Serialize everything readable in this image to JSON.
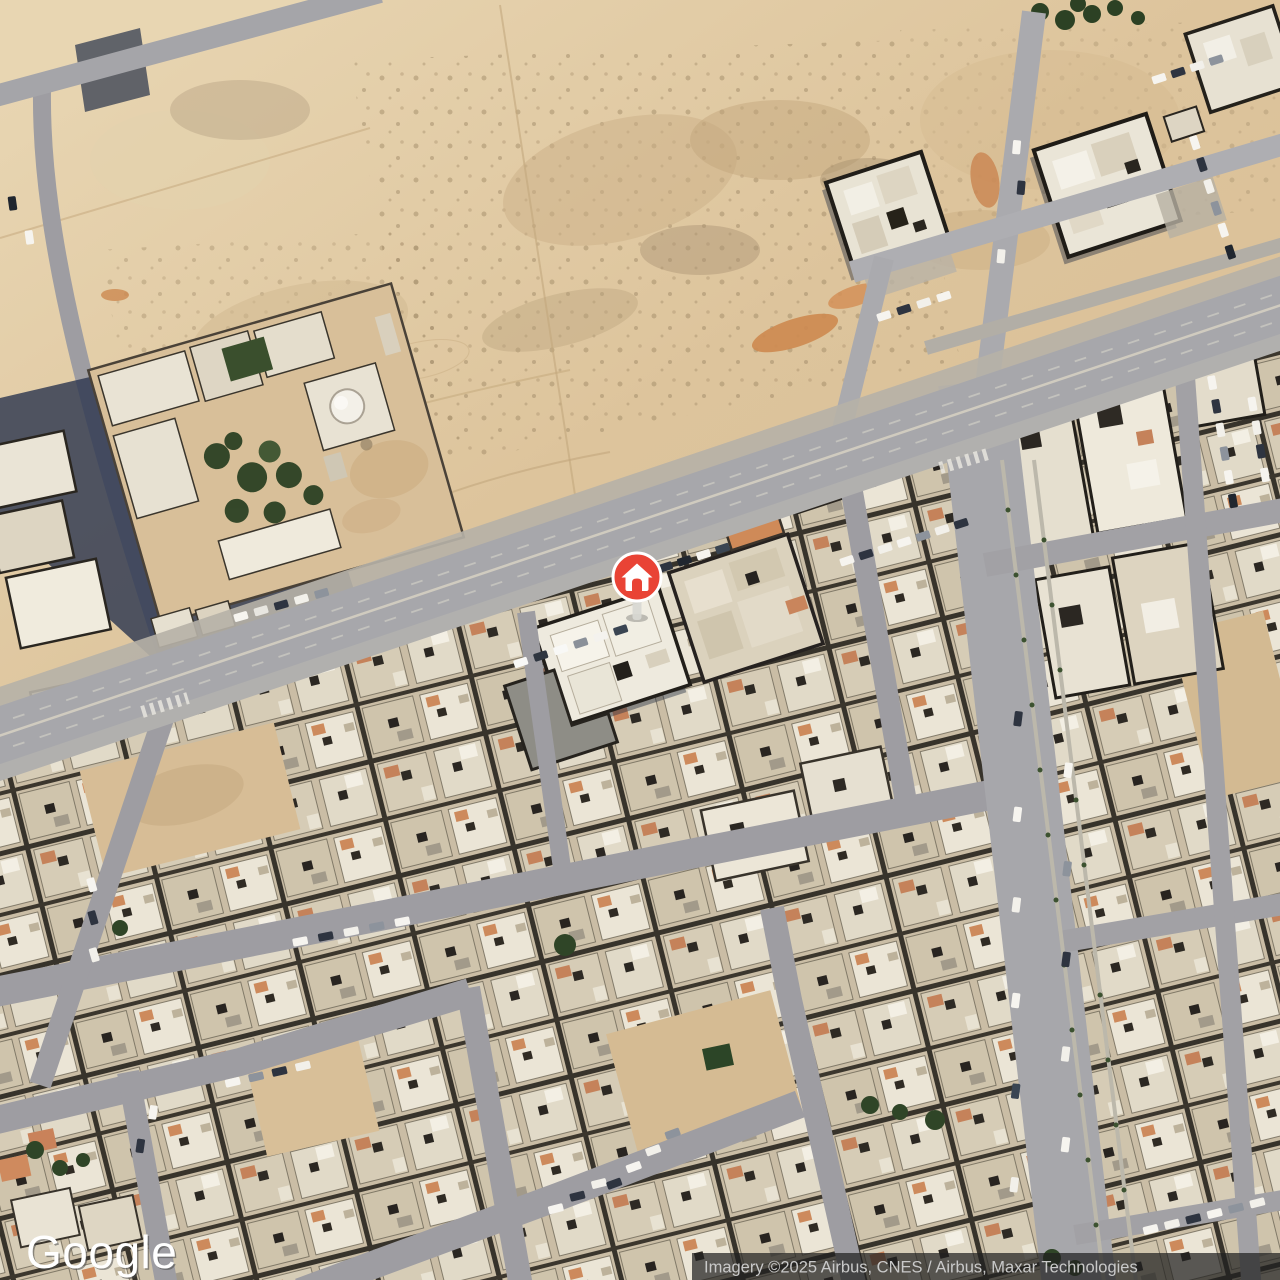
{
  "map": {
    "view_type": "satellite",
    "scene": "desert city blocks with empty sand lots, a walled compound with dome and palm trees, a main diagonal avenue and a vertical boulevard",
    "marker": {
      "label": "home",
      "icon": "home-icon",
      "color": "#e94335",
      "border_color": "#ffffff",
      "x": 637,
      "y": 577
    },
    "google_logo_text": "Google",
    "attribution_text": "Imagery ©2025 Airbus, CNES / Airbus, Maxar Technologies",
    "colors": {
      "sand_light": "#e9d7b4",
      "sand_mid": "#ddc49c",
      "sand_dark": "#c9ae84",
      "orange_dirt": "#cd8950",
      "road_asphalt": "#a7a7ab",
      "road_light": "#b7b2a8",
      "building_cream": "#d6ccb6",
      "building_white": "#eeeade",
      "wall_dark": "#26231e",
      "shadow_navy": "#2e3850",
      "terracotta": "#c5825a",
      "tree_green": "#2c4124",
      "marker_red": "#e94335",
      "attribution_bg": "rgba(32,32,32,0.72)",
      "attribution_text_color": "#c9c9c9",
      "logo_color": "#ffffff"
    }
  }
}
